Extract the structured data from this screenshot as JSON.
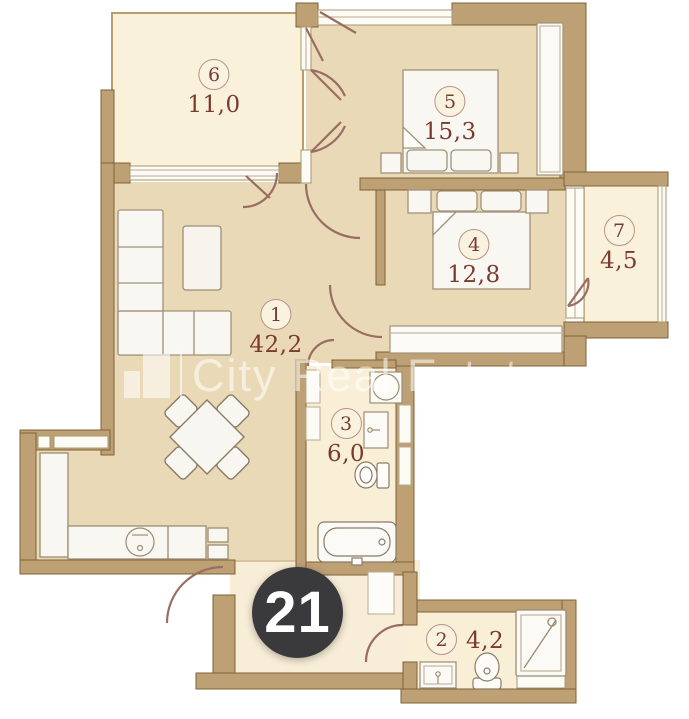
{
  "plan": {
    "watermark": "City Real Estate",
    "badge_label": "21",
    "rooms": [
      {
        "number": "1",
        "area": "42,2"
      },
      {
        "number": "2",
        "area": "4,2"
      },
      {
        "number": "3",
        "area": "6,0"
      },
      {
        "number": "4",
        "area": "12,8"
      },
      {
        "number": "5",
        "area": "15,3"
      },
      {
        "number": "6",
        "area": "11,0"
      },
      {
        "number": "7",
        "area": "4,5"
      }
    ],
    "colors": {
      "wall": "#bda174",
      "wall_outline": "#7e6239",
      "floor_main": "#ead9b6",
      "floor_light": "#f9efd6",
      "window": "#fdfbf6",
      "furniture": "#f9f7f1",
      "door_arc": "#9a6d63",
      "label_text": "#7a3a30",
      "badge_bg": "#3a393b",
      "badge_text": "#ffffff"
    }
  }
}
